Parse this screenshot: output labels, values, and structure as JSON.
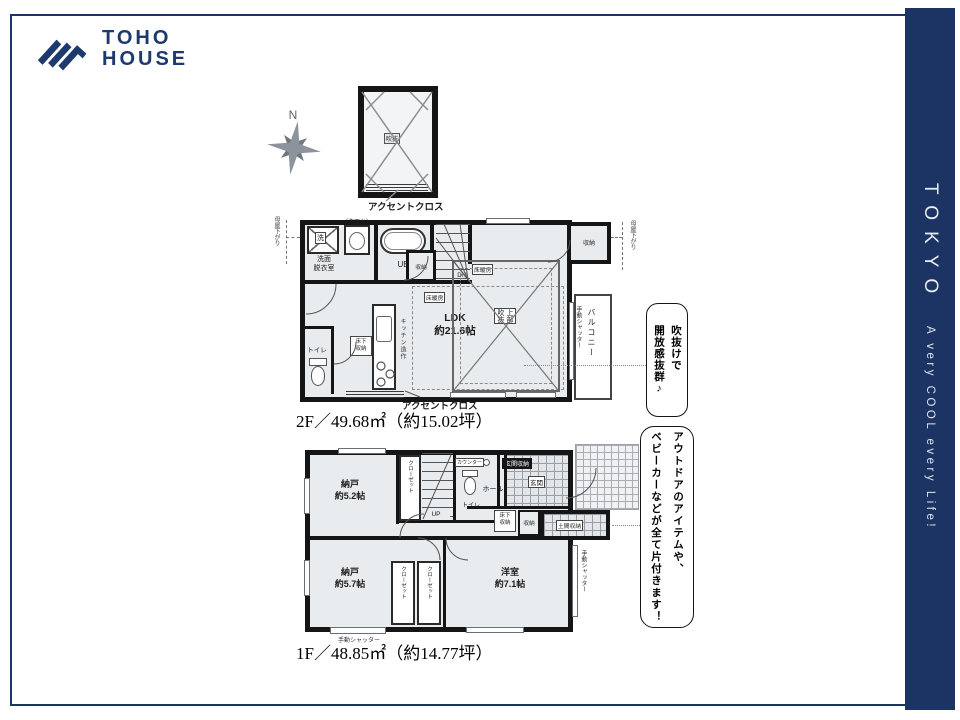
{
  "brand": {
    "name1": "TOHO",
    "name2": "HOUSE"
  },
  "banner": {
    "title": "TOKYO",
    "tagline": "A very COOL every Life!"
  },
  "compass": {
    "n": "N"
  },
  "attic": {
    "room": "吹抜",
    "caption": "アクセントクロス"
  },
  "f2": {
    "area": "2F／49.68㎡（約15.02坪）",
    "moyaL": "母屋下がり",
    "moyaR": "母屋下がり",
    "washer": "洗",
    "vanity": "（洗面台）",
    "powder": "洗面\n脱衣室",
    "ub": "UB",
    "stair_storage": "収納",
    "dn": "DN",
    "toilet": "トイレ",
    "floor_box": "床下\n収納",
    "kitchen": "キッチン造作",
    "ldk": "LDK\n約21.6帖",
    "heat1": "床暖房",
    "heat2": "床暖房",
    "void": "上部\n吹抜",
    "storage": "収納",
    "shutter": "手動シャッター",
    "balcony": "バルコニー",
    "accent": "アクセントクロス",
    "bubble": "吹抜けで\n開放感抜群♪"
  },
  "f1": {
    "area": "1F／48.85㎡（約14.77坪）",
    "storage52": "納戸\n約5.2帖",
    "closet_top": "クローゼット",
    "up": "UP",
    "counter": "カウンター",
    "toilet": "トイレ",
    "hall": "ホール",
    "genkan": "玄関",
    "genkan_storage": "玄関収納",
    "floor_box": "床下\n収納",
    "storage": "収納",
    "doma": "土間収納",
    "storage57": "納戸\n約5.7帖",
    "closet_l": "クローゼット",
    "closet_r": "クローゼット",
    "western": "洋室\n約7.1帖",
    "shutter_b": "手動シャッター",
    "shutter_r": "手動シャッター",
    "bubble": "アウトドアのアイテムや、\nベビーカーなどが全て片付きます！"
  }
}
